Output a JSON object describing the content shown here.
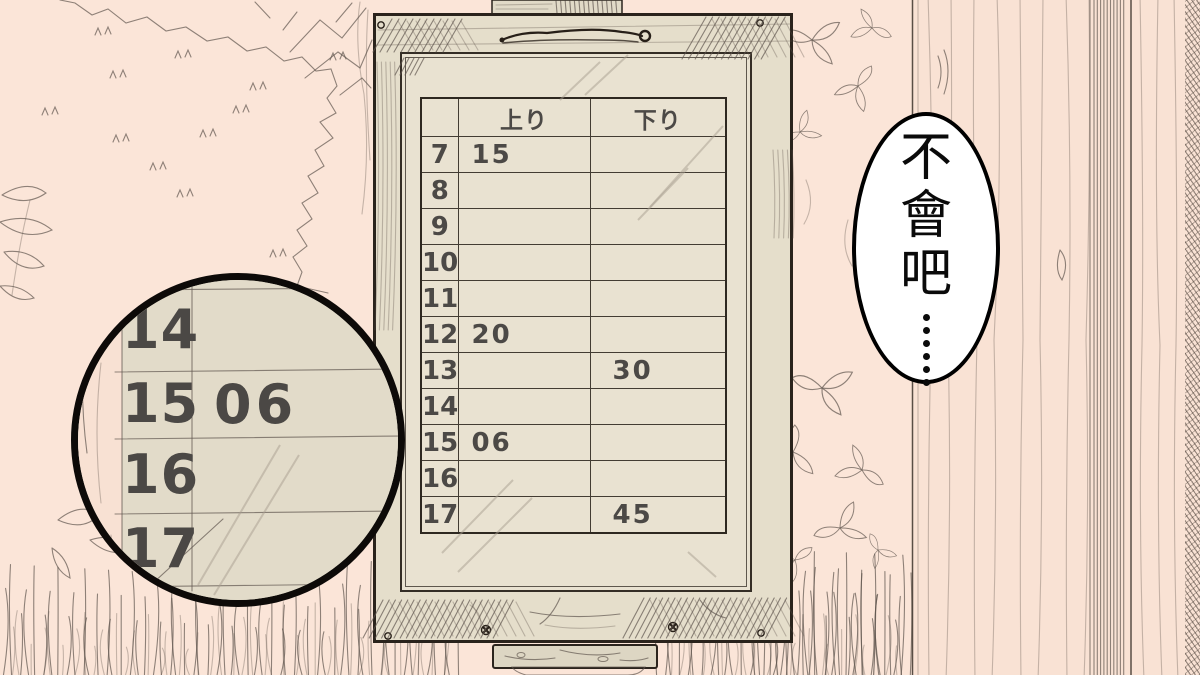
{
  "colors": {
    "background": "#fbe5d8",
    "wall": "#f9e2d4",
    "board_panel": "#e9e2d1",
    "board_frame": "#e5decb",
    "magnifier_panel": "#e2dbc9",
    "ink": "#2a231c",
    "number": "#4c4946",
    "bubble_fill": "#ffffff",
    "bubble_border": "#000000"
  },
  "timetable": {
    "headers": {
      "up": "上り",
      "down": "下り"
    },
    "rows": [
      {
        "hour": "7",
        "up": "15",
        "down": ""
      },
      {
        "hour": "8",
        "up": "",
        "down": ""
      },
      {
        "hour": "9",
        "up": "",
        "down": ""
      },
      {
        "hour": "10",
        "up": "",
        "down": ""
      },
      {
        "hour": "11",
        "up": "",
        "down": ""
      },
      {
        "hour": "12",
        "up": "20",
        "down": ""
      },
      {
        "hour": "13",
        "up": "",
        "down": "30"
      },
      {
        "hour": "14",
        "up": "",
        "down": ""
      },
      {
        "hour": "15",
        "up": "06",
        "down": ""
      },
      {
        "hour": "16",
        "up": "",
        "down": ""
      },
      {
        "hour": "17",
        "up": "",
        "down": "45"
      }
    ]
  },
  "magnifier": {
    "rows": [
      {
        "hour": "14",
        "value": ""
      },
      {
        "hour": "15",
        "value": "06"
      },
      {
        "hour": "16",
        "value": ""
      },
      {
        "hour": "17",
        "value": ""
      }
    ]
  },
  "speech_bubble": {
    "text": "不會吧",
    "ellipsis_dot_count": 6
  }
}
